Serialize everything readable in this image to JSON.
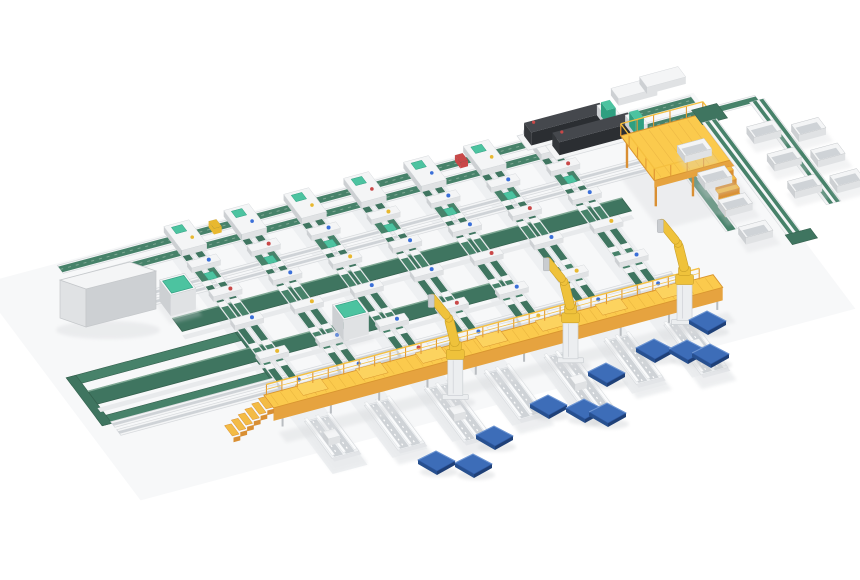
{
  "scene": {
    "description": "isometric-3d-render-automated-parcel-sorting-system",
    "canvas": {
      "width": 860,
      "height": 580,
      "background": "#ffffff"
    },
    "palette": {
      "beltA": "#47826a",
      "beltB": "#3f7560",
      "beltDark": "#35624f",
      "beltLight": "#7fa894",
      "white": "#f4f5f6",
      "frameFront": "#e0e2e4",
      "frameSide": "#cdd0d3",
      "stroke": "#c5c8cb",
      "laneShadow": "#eef0f2",
      "innerGray": "#cfd3d7",
      "railEdge": "#d7dadd",
      "mint": "#4cc3a0",
      "mintDark": "#2f9f80",
      "beamTop": "#fbca4d",
      "beamFront": "#e6a33f",
      "beamEdge": "#d9952f",
      "railY": "#f5c040",
      "post": "#e29b35",
      "stepTop": "#f3bb45",
      "stepSide": "#d98f33",
      "robotY": "#efc23b",
      "robotYD": "#caa028",
      "pedestal": "#eceef0",
      "pedEdge": "#ccd0d4",
      "palTop": "#3d6db8",
      "palEdge": "#2c56a0",
      "palL": "#27508f",
      "palR": "#1f4077",
      "palHi": "#6f97d4",
      "machTop": "#45484d",
      "machSide": "#34373b",
      "machFront": "#2b2e32",
      "dotRed": "#c94848",
      "dotBlue": "#3a6fd8",
      "dotYellow": "#e8b830",
      "shadow": "#d4d6d9",
      "legGray": "#b9bdc1",
      "slat": "#ffffff"
    },
    "geometry": {
      "origin": [
        150,
        242
      ],
      "ux": 0.966,
      "uy": -0.259,
      "vx": 0.6,
      "vy": 0.8
    },
    "spine": {
      "u0": -95,
      "u1": 560,
      "rails_v": [
        0,
        16
      ],
      "station_dots": [
        "dotYellow",
        "dotBlue",
        "dotYellow",
        "dotRed",
        "dotBlue",
        "dotYellow",
        "dotBlue"
      ],
      "items": [
        {
          "u": 60,
          "c": "dotYellow"
        },
        {
          "u": 155,
          "c": "dotBlue"
        },
        {
          "u": 315,
          "c": "dotRed"
        }
      ]
    },
    "lanes": {
      "u_list": [
        30,
        92,
        154,
        216,
        278,
        340,
        402
      ],
      "v0": 8,
      "v1": 212,
      "rail_offsets": [
        -11,
        2
      ],
      "rail_w": 7,
      "bridge_vs": [
        36,
        72,
        108,
        150,
        186
      ],
      "dot_cycle": [
        "dotBlue",
        "dotRed",
        "dotBlue",
        "dotYellow",
        "dotBlue"
      ],
      "mint_cap_v": 48,
      "tail_v0": 230,
      "tail_lens": [
        46,
        56,
        66,
        58,
        70,
        54,
        62
      ]
    },
    "cross_rails": [
      {
        "u0": -60,
        "u1": 548,
        "v": 50
      },
      {
        "u0": -60,
        "u1": 548,
        "v": 60
      },
      {
        "u0": -150,
        "u1": 430,
        "v": 176
      },
      {
        "u0": -150,
        "u1": 430,
        "v": 186
      }
    ],
    "cross_belts": [
      {
        "u0": -30,
        "u1": 435,
        "v": 86,
        "w": 16
      },
      {
        "u0": -150,
        "u1": 285,
        "v": 138,
        "w": 16
      }
    ],
    "loop": {
      "u0": -160,
      "u1": 25,
      "v0": 118,
      "v1": 178,
      "band": 10
    },
    "cabinet_big": {
      "top": [
        [
          60,
          280
        ],
        [
          130,
          262
        ],
        [
          156,
          271
        ],
        [
          86,
          289
        ]
      ],
      "front": [
        [
          60,
          280
        ],
        [
          86,
          289
        ],
        [
          86,
          327
        ],
        [
          60,
          318
        ]
      ],
      "side": [
        [
          86,
          289
        ],
        [
          156,
          271
        ],
        [
          156,
          309
        ],
        [
          86,
          327
        ]
      ]
    },
    "mint_cabinets": [
      {
        "u": -30,
        "v": 64
      },
      {
        "u": 103,
        "v": 138
      }
    ],
    "mint_cabinet_size": {
      "du": 26,
      "dv": 19,
      "h": 21
    },
    "machines": [
      {
        "u": 385,
        "v": -8
      },
      {
        "u": 403,
        "v": 10
      }
    ],
    "white_tables": [
      {
        "u": 492,
        "v": -24
      },
      {
        "u": 524,
        "v": -28
      }
    ],
    "mezzanine": {
      "u0": 455,
      "u1": 540,
      "v0": 52,
      "v1": 108,
      "h": 30
    },
    "under_mezz_line": {
      "u": 505,
      "v0": 26,
      "v1": 150
    },
    "right_section": {
      "ext": {
        "u0": 552,
        "u1": 616,
        "v": 16
      },
      "corner": {
        "u": 552,
        "v": 14,
        "du": 26,
        "dv": 18
      },
      "lineA": {
        "u": 556,
        "v0": 30,
        "v1": 178
      },
      "turnA": {
        "u": 552,
        "v": 170,
        "du": 26,
        "dv": 12
      },
      "lineB": {
        "u": 610,
        "v0": 22,
        "v1": 150
      },
      "bins": [
        {
          "u": 512,
          "vs": [
            54,
            88,
            122,
            156
          ]
        },
        {
          "u": 584,
          "vs": [
            54,
            88,
            122
          ]
        },
        {
          "u": 624,
          "vs": [
            64,
            96,
            128
          ]
        }
      ],
      "bin": {
        "du": 28,
        "dv": 13,
        "h": 7
      }
    },
    "beam": {
      "u0": -15,
      "u1": 450,
      "v0": 214,
      "v1": 230,
      "h": 22,
      "leg_step": 50,
      "rail_step": 16
    },
    "beam_stair": {
      "steps": 6,
      "step_du": 7,
      "rise": 3.6
    },
    "robots": [
      {
        "u": 162,
        "v": 248
      },
      {
        "u": 285,
        "v": 242
      },
      {
        "u": 408,
        "v": 234
      }
    ],
    "pallets": [
      [
        495,
        438
      ],
      [
        437,
        463
      ],
      [
        474,
        466
      ],
      [
        607,
        375
      ],
      [
        549,
        407
      ],
      [
        585,
        411
      ],
      [
        608,
        415
      ],
      [
        708,
        323
      ],
      [
        655,
        351
      ],
      [
        688,
        352
      ],
      [
        711,
        356
      ]
    ]
  }
}
